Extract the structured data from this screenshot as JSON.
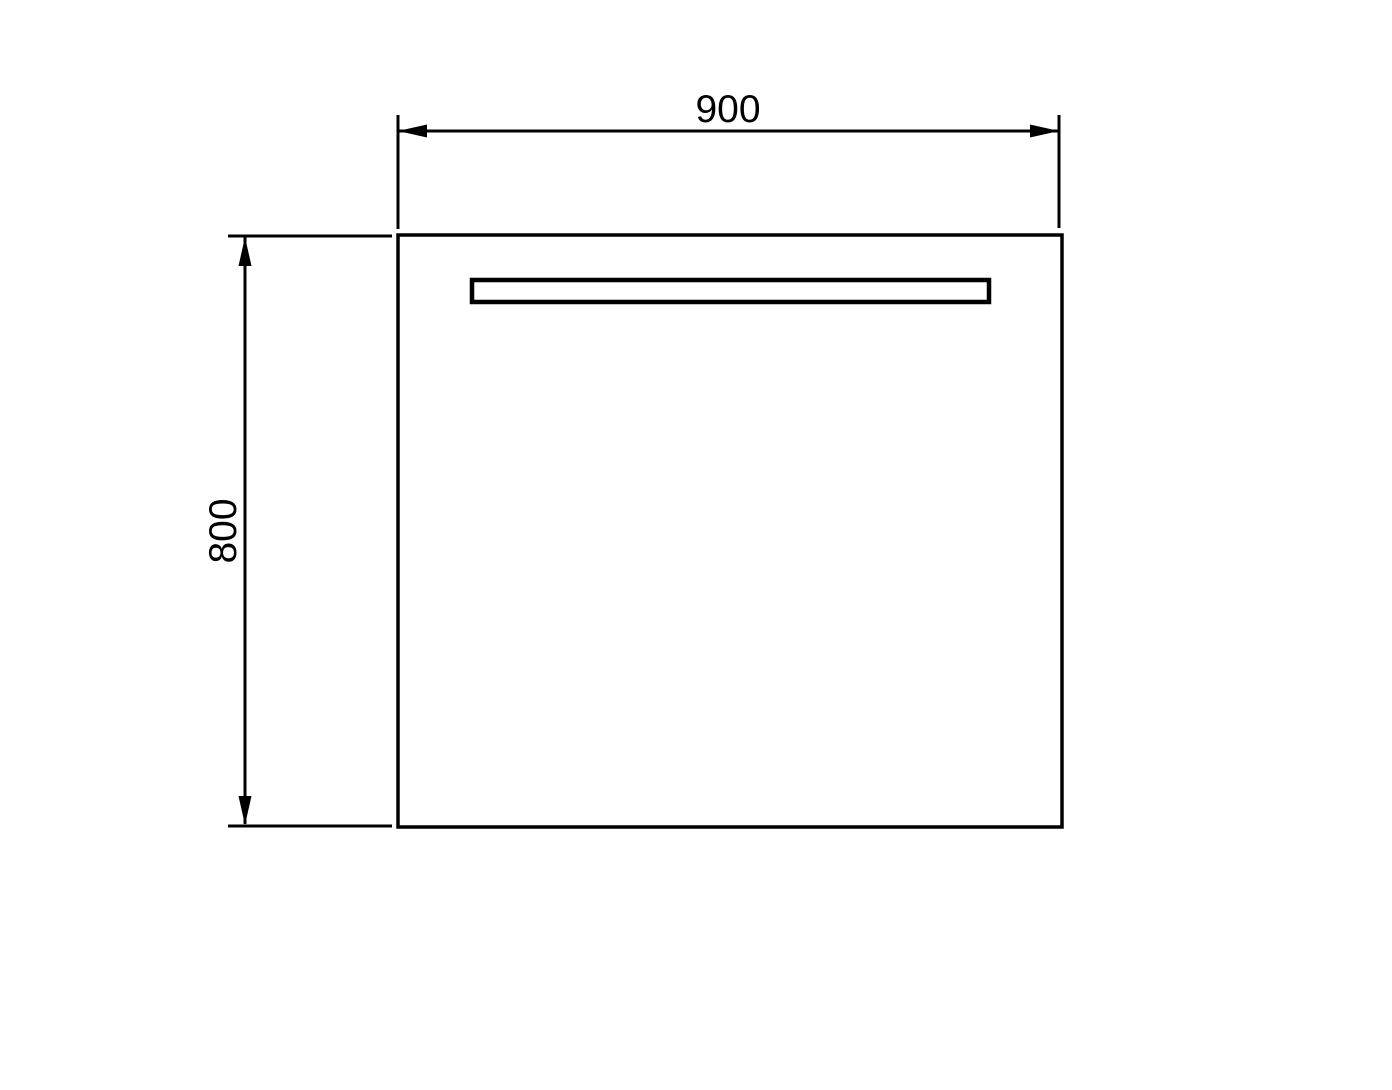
{
  "diagram": {
    "dimensions": {
      "width": {
        "label": "900"
      },
      "height": {
        "label": "800"
      }
    },
    "colors": {
      "line": "#000000",
      "background": "#ffffff"
    }
  }
}
